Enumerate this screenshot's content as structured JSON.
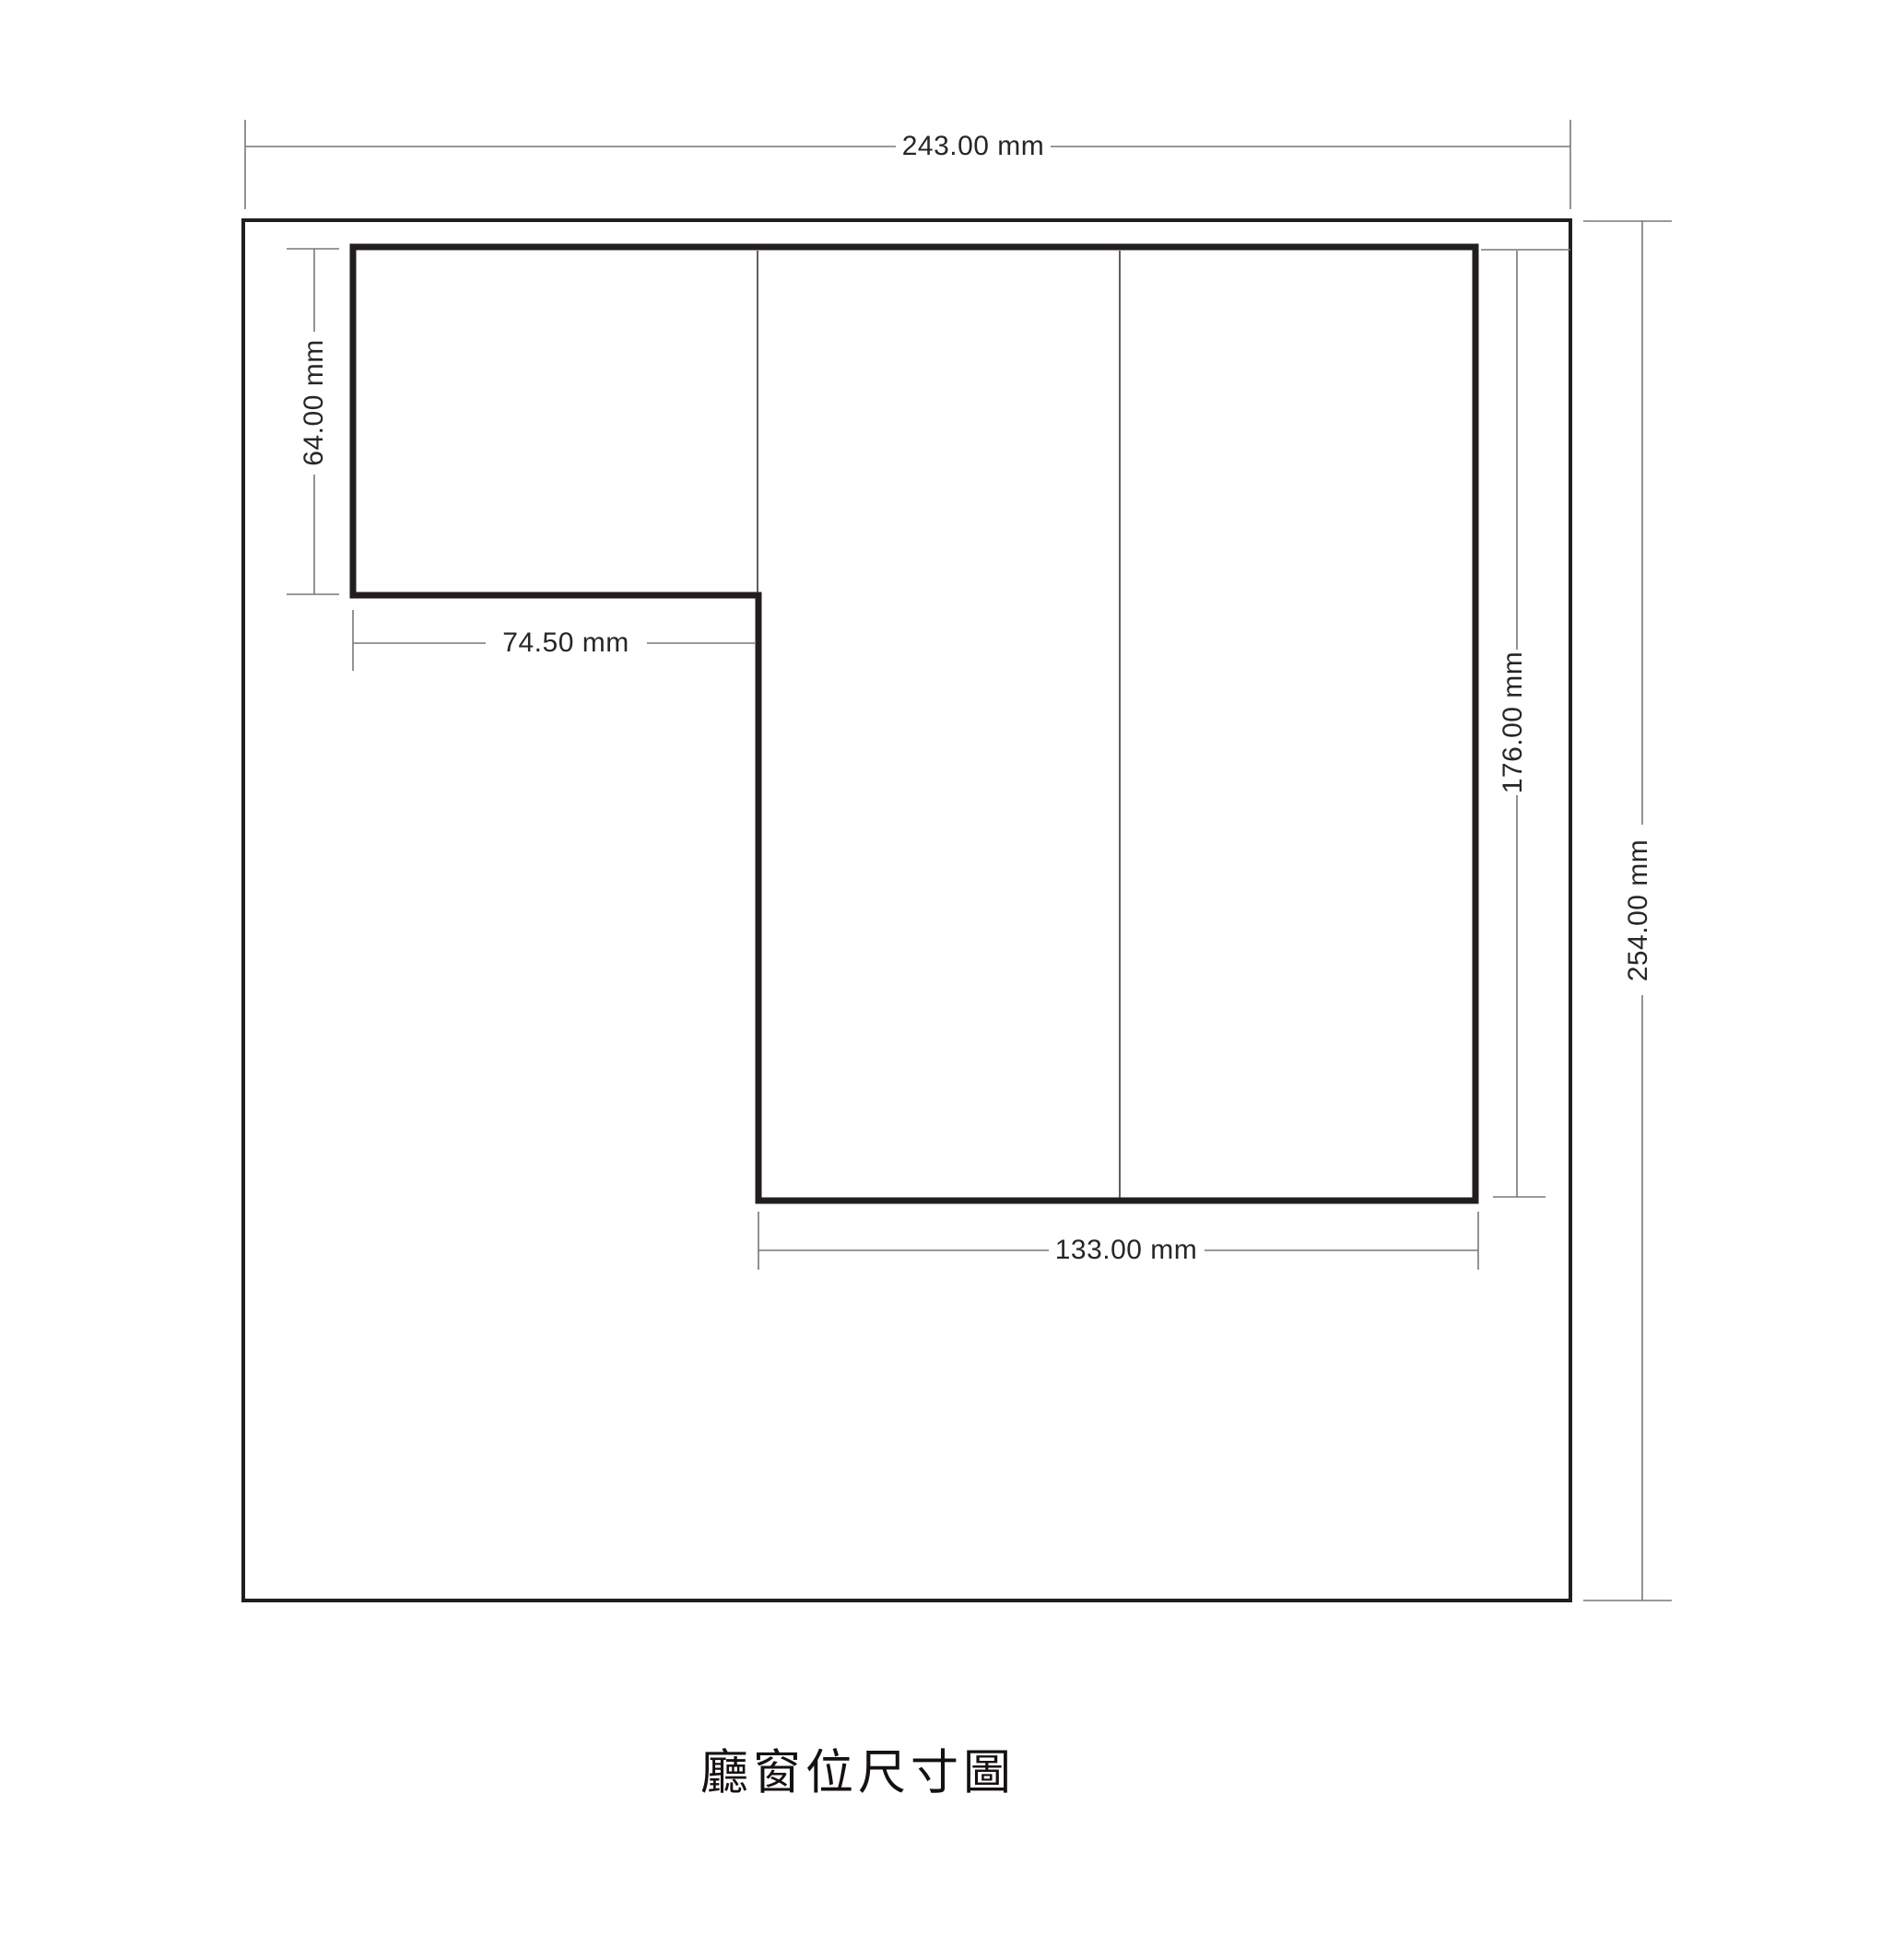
{
  "page": {
    "caption": "廳窗位尺寸圖"
  },
  "drawing": {
    "type": "dimension-diagram",
    "unit": "mm",
    "dimensions": {
      "overall_width": {
        "label": "243.00 mm",
        "value": 243.0,
        "unit": "mm"
      },
      "overall_height": {
        "label": "254.00 mm",
        "value": 254.0,
        "unit": "mm"
      },
      "left_section_height": {
        "label": "64.00 mm",
        "value": 64.0,
        "unit": "mm"
      },
      "left_section_width": {
        "label": "74.50 mm",
        "value": 74.5,
        "unit": "mm"
      },
      "right_section_height": {
        "label": "176.00 mm",
        "value": 176.0,
        "unit": "mm"
      },
      "bottom_section_width": {
        "label": "133.00 mm",
        "value": 133.0,
        "unit": "mm"
      }
    },
    "colors": {
      "outline": "#221e1f",
      "dimline": "#7b7775",
      "labeltext": "#2a2526",
      "titletext": "#151110"
    }
  }
}
